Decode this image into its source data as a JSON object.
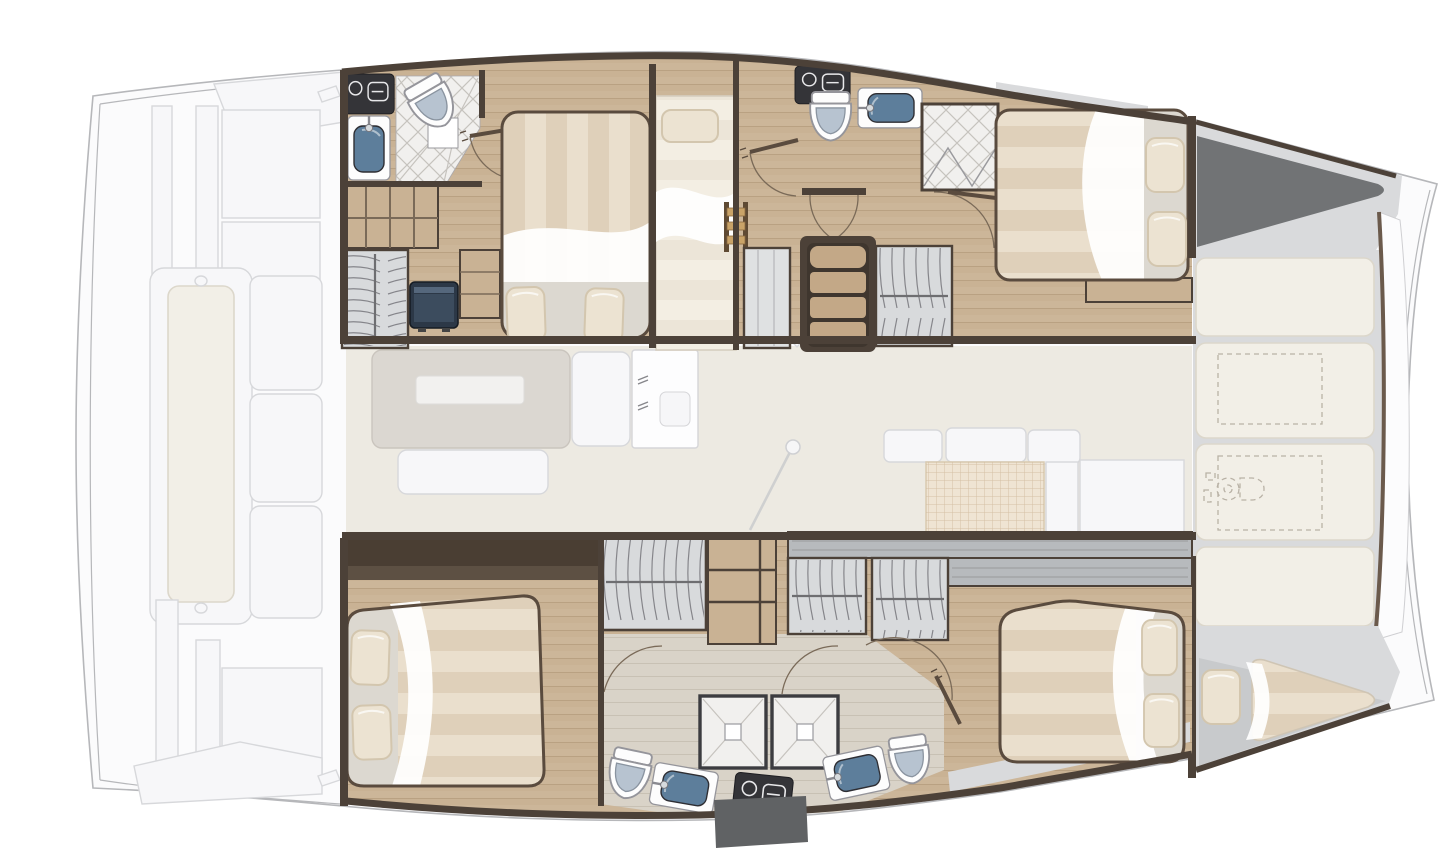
{
  "page": {
    "width": 1440,
    "height": 868,
    "background": "#ffffff"
  },
  "diagram": {
    "type": "yacht-floor-plan",
    "subject": "sailing catamaran interior layout, top-down view",
    "orientation": {
      "bow": "right",
      "stern": "left",
      "port_hull": "top",
      "starboard_hull": "bottom"
    },
    "areas": [
      {
        "id": "aft-deck",
        "label": "aft cockpit and platform (ghosted exterior)"
      },
      {
        "id": "saloon",
        "label": "saloon with dining table, sofa and galley (ghosted deck furniture)"
      },
      {
        "id": "port-aft-head",
        "label": "port aft bathroom with shower"
      },
      {
        "id": "port-wardrobe",
        "label": "port shelving and hanging locker with TV"
      },
      {
        "id": "port-aft-cabin",
        "label": "port aft double cabin"
      },
      {
        "id": "port-bunk-cabin",
        "label": "port single bunk cabin"
      },
      {
        "id": "port-mid-head",
        "label": "port forward bathroom with shower stall"
      },
      {
        "id": "port-companionway",
        "label": "port companionway stairs"
      },
      {
        "id": "port-fwd-cabin",
        "label": "port forward double cabin"
      },
      {
        "id": "port-forepeak",
        "label": "port forepeak storage (dark triangle)"
      },
      {
        "id": "foredeck",
        "label": "foredeck sunpad cushions with deck hatches and windlass"
      },
      {
        "id": "starboard-aft-cabin",
        "label": "starboard aft double cabin"
      },
      {
        "id": "starboard-dressing",
        "label": "starboard hanging lockers and shelves"
      },
      {
        "id": "starboard-heads",
        "label": "starboard bathrooms with twin shower stalls"
      },
      {
        "id": "starboard-fwd-cabin",
        "label": "starboard forward double cabin"
      },
      {
        "id": "starboard-forepeak",
        "label": "starboard forepeak single berth"
      }
    ],
    "fixtures": {
      "double_beds": 4,
      "single_berths": 2,
      "toilets": 4,
      "sinks": 4,
      "vanity_counters": 4,
      "showers": 4,
      "hanging_lockers": 5,
      "companionway_stairs": 1,
      "bunk_ladders": 1,
      "sunpad_panels": 4,
      "deck_hatches_dashed": 2,
      "windlass": 1
    },
    "colors": {
      "wall": "#4c4138",
      "wood": "#c9b294",
      "woodline": "#a98f6f",
      "woodlt": "#d9d3c8",
      "woodltline": "#bdb5a7",
      "saloon": "#edeae2",
      "ghostfill": "#f7f7f9",
      "ghostline": "#d7d8db",
      "hull": "#fbfbfc",
      "hullline": "#b6b7ba",
      "marble": "#d9dadc",
      "darktri": "#717375",
      "locker": "#d8dadc",
      "hanger": "#85858a",
      "rod": "#6e6e71",
      "tile": "#f1f0ee",
      "tileline": "#c6c3be",
      "porcelain": "#fdfdfd",
      "lid": "#b7c3d0",
      "basin": "#5d7e9b",
      "counter": "#343438",
      "glyph": "#e8e8ea",
      "cushion": "#f2efe7",
      "cushionline": "#dcd7cb",
      "stripea": "#dfd0ba",
      "stripeb": "#eadfcd",
      "stripc": "#ece5d8",
      "stripd": "#f3eee3",
      "sheetzone": "#dcd8d0",
      "pillow": "#ece3d2",
      "pillowline": "#d3c6ae",
      "frame": "#5a4b3e",
      "stepwood": "#c3a887",
      "stepdark": "#3f362e",
      "arc": "#7a6a58",
      "leaf": "#5a4b3e",
      "grayshelf": "#b7babd",
      "berthfloor": "#c8cacc",
      "dash": "#b9b2a6",
      "tv": "#2c3847",
      "brownband": "#4a3e33",
      "brownband2": "#5d5043",
      "patch": "#606264",
      "gridtable": "#efe4d3",
      "gridline": "#cdb698"
    }
  }
}
